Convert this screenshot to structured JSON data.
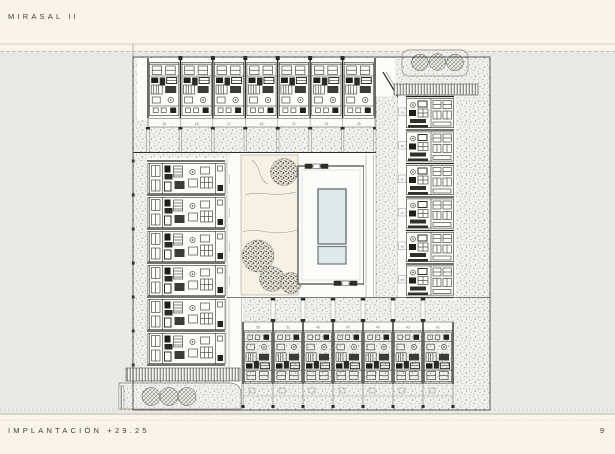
{
  "header": {
    "title": "MIRASAL II"
  },
  "footer": {
    "label": "IMPLANTACIÓN +29.25",
    "page_number": "9"
  },
  "colors": {
    "page_background": "#f8f4e9",
    "band_background": "#e9e9e6",
    "plan_line": "#2f2f2b",
    "white_surface": "#fcfcfa",
    "pool_fill": "#dfe9e8",
    "pool_border": "#6d7878",
    "garden_fill": "#f6f1e2",
    "number_text": "#6b6b64"
  },
  "plan": {
    "drawing_title": "IMPLANTACIÓN",
    "level": "+29.25",
    "rows": {
      "top": {
        "numbers": [
          "15",
          "16",
          "17",
          "18",
          "21",
          "23",
          "25"
        ]
      },
      "right": {
        "numbers": [
          "28",
          "30",
          "32",
          "34",
          "36",
          "38"
        ]
      },
      "left": {
        "numbers": [
          "02",
          "04",
          "06",
          "08",
          "10",
          "12"
        ]
      },
      "bottom": {
        "numbers": [
          "53",
          "51",
          "49",
          "47",
          "45",
          "43",
          "41"
        ]
      }
    }
  }
}
